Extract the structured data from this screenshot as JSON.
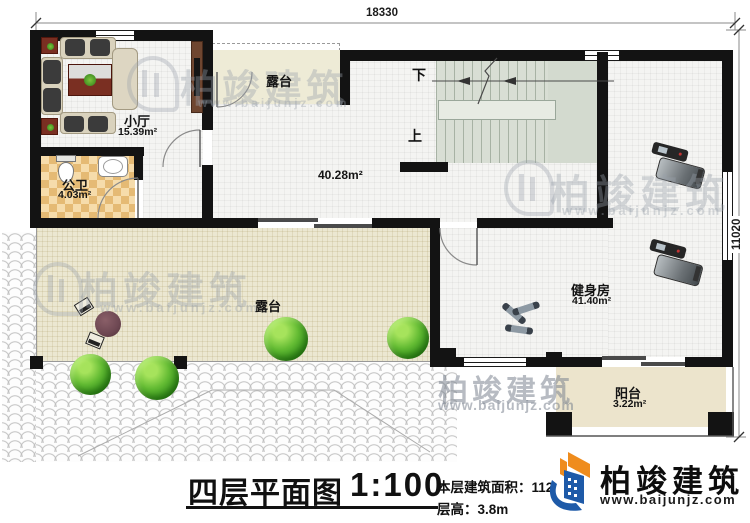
{
  "dimensions": {
    "top_width": "18330",
    "right_height": "11020"
  },
  "rooms": {
    "small_hall": {
      "name": "小厅",
      "area": "15.39m²"
    },
    "public_bath": {
      "name": "公卫",
      "area": "4.03m²"
    },
    "terrace_top": {
      "name": "露台"
    },
    "main_hall": {
      "area": "40.28m²"
    },
    "gym": {
      "name": "健身房",
      "area": "41.40m²"
    },
    "terrace_main": {
      "name": "露台"
    },
    "balcony": {
      "name": "阳台",
      "area": "3.22m²"
    }
  },
  "stairs": {
    "down_label": "下",
    "up_label": "上"
  },
  "title_block": {
    "title": "四层平面图",
    "scale": "1:100",
    "floor_area_label": "本层建筑面积：112",
    "floor_height_label": "层高：3.8m"
  },
  "branding": {
    "company": "柏竣建筑",
    "website": "www.baijunjz.com"
  },
  "watermark": {
    "company": "柏竣建筑",
    "website": "www.baijunjz.com"
  },
  "colors": {
    "wall": "#131313",
    "logo_orange": "#ef8c1d",
    "logo_blue": "#1e5aa8"
  }
}
